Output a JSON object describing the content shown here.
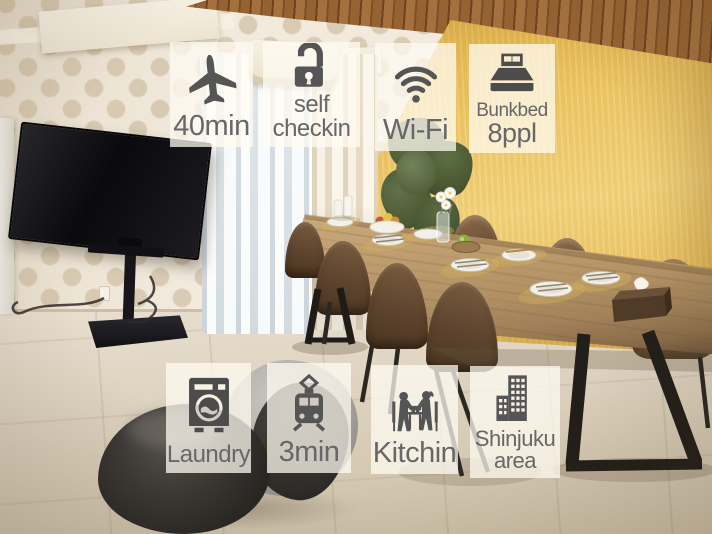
{
  "badges": {
    "style": {
      "background": "rgba(255,251,242,0.75)",
      "icon_color": "#555555",
      "text_color": "#676767"
    },
    "items": [
      {
        "name": "airport-access",
        "icon": "airplane-icon",
        "lines": [
          "40min"
        ]
      },
      {
        "name": "self-checkin",
        "icon": "open-padlock-icon",
        "lines": [
          "self",
          "checkin"
        ]
      },
      {
        "name": "wifi",
        "icon": "wifi-icon",
        "lines": [
          "Wi-Fi"
        ]
      },
      {
        "name": "bunkbed-capacity",
        "icon": "double-bed-icon",
        "lines": [
          "Bunkbed",
          "8ppl"
        ]
      },
      {
        "name": "laundry",
        "icon": "washing-machine-icon",
        "lines": [
          "Laundry"
        ]
      },
      {
        "name": "station-access",
        "icon": "train-icon",
        "lines": [
          "3min"
        ]
      },
      {
        "name": "kitchen",
        "icon": "dining-couple-icon",
        "lines": [
          "Kitchin"
        ]
      },
      {
        "name": "shinjuku-area",
        "icon": "city-buildings-icon",
        "lines": [
          "Shinjuku",
          "area"
        ]
      }
    ]
  },
  "palette": {
    "wall_yellow": "#EFC765",
    "wallpaper_cream": "#F1EADD",
    "wallpaper_dot": "#D9CBB4",
    "ceiling_wood": "#956332",
    "curtain_white": "#EFF2F4",
    "curtain_cream": "#EFE7D5",
    "floor_beige": "#DED3C0",
    "table_wood": "#B39366",
    "chair_brown": "#76583D",
    "beanbag_charcoal": "#2F2C29",
    "beanbag_gray": "#B1ADA9",
    "tv_black": "#0B0B0D"
  }
}
